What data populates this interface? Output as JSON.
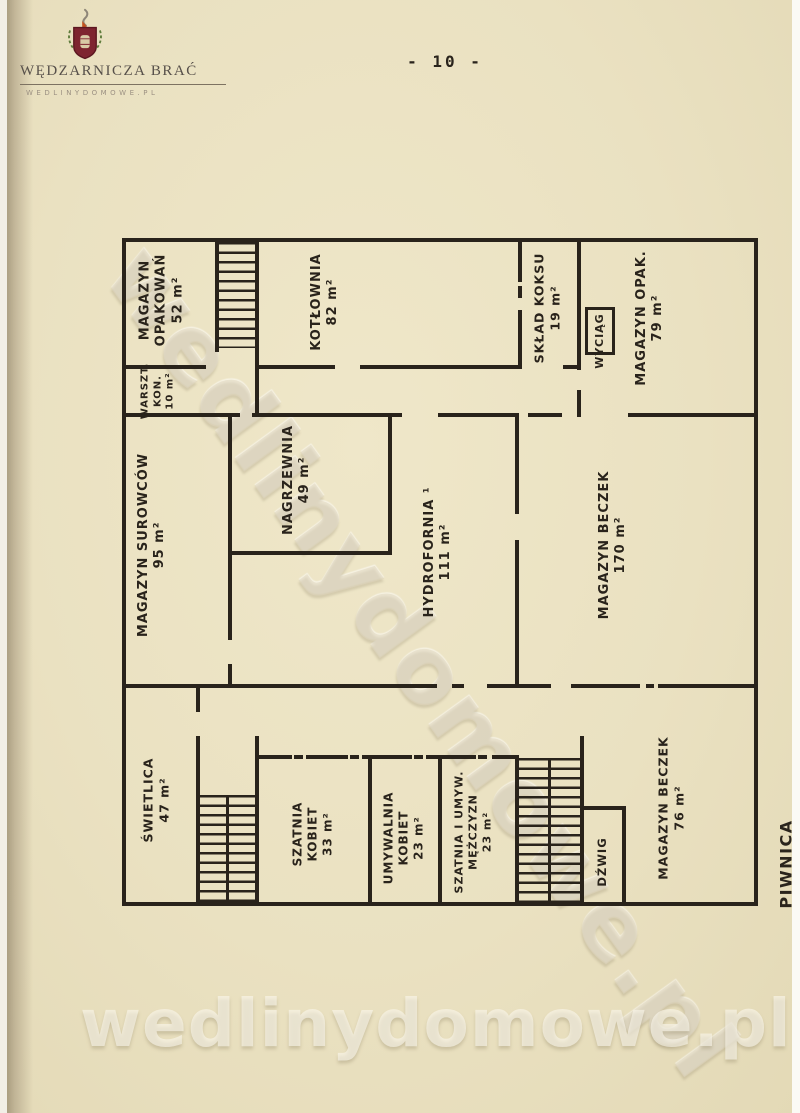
{
  "page": {
    "number_label": "- 10 -"
  },
  "logo": {
    "title": "WĘDZARNICZA BRAĆ",
    "subtitle": "WEDLINYDOMOWE.PL",
    "crest_red": "#7e2430",
    "crest_dark_red": "#5c1720",
    "leaf_green": "#5f7c3c",
    "smoke_gray": "#8e8678",
    "flame_orange": "#c2521f"
  },
  "watermark": {
    "diagonal_text": "wedlinydomowe.pl",
    "bottom_text": "wedlinydomowe.pl"
  },
  "plan": {
    "title": "PIWNICA",
    "ink_color": "#29231b",
    "rooms": [
      {
        "id": "magazyn-opakowan",
        "lines": [
          "MAGAZYN",
          "OPAKOWAŃ",
          "52 m²"
        ]
      },
      {
        "id": "kotlownia",
        "lines": [
          "KOTŁOWNIA",
          "82 m²"
        ]
      },
      {
        "id": "sklad-koksu",
        "lines": [
          "SKŁAD KOKSU",
          "19 m²"
        ]
      },
      {
        "id": "wyciag",
        "lines": [
          "WYCIĄG"
        ]
      },
      {
        "id": "magazyn-opak",
        "lines": [
          "MAGAZYN OPAK.",
          "79 m²"
        ]
      },
      {
        "id": "warszt-kon",
        "lines": [
          "WARSZT.",
          "KON.",
          "10 m²"
        ]
      },
      {
        "id": "magazyn-surowcow",
        "lines": [
          "MAGAZYN SUROWCÓW",
          "95 m²"
        ]
      },
      {
        "id": "nagrzewnia",
        "lines": [
          "NAGRZEWNIA",
          "49 m²"
        ]
      },
      {
        "id": "hydrofornia",
        "lines": [
          "HYDROFORNIA ¹",
          "111 m²"
        ]
      },
      {
        "id": "magazyn-beczek-170",
        "lines": [
          "MAGAZYN BECZEK",
          "170 m²"
        ]
      },
      {
        "id": "swietlica",
        "lines": [
          "ŚWIETLICA",
          "47 m²"
        ]
      },
      {
        "id": "szatnia-kobiet",
        "lines": [
          "SZATNIA",
          "KOBIET",
          "33 m²"
        ]
      },
      {
        "id": "umywalnia-kobiet",
        "lines": [
          "UMYWALNIA",
          "KOBIET",
          "23 m²"
        ]
      },
      {
        "id": "szatnia-umyw-mezczyzn",
        "lines": [
          "SZATNIA I UMYW.",
          "MĘŻCZYZN",
          "23 m²"
        ]
      },
      {
        "id": "dzwig",
        "lines": [
          "DŹWIG"
        ]
      },
      {
        "id": "magazyn-beczek-76",
        "lines": [
          "MAGAZYN BECZEK",
          "76 m²"
        ]
      }
    ]
  }
}
